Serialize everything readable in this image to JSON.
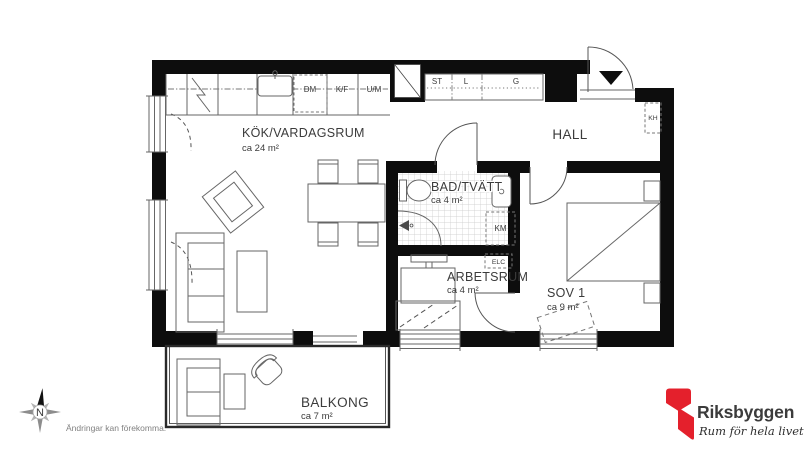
{
  "plan": {
    "rooms": {
      "kitchen_living": {
        "name": "KÖK/VARDAGSRUM",
        "area": "ca 24 m²"
      },
      "hall": {
        "name": "HALL"
      },
      "bath": {
        "name": "BAD/TVÄTT",
        "area": "ca 4 m²"
      },
      "office": {
        "name": "ARBETSRUM",
        "area": "ca 4 m²"
      },
      "bedroom": {
        "name": "SOV 1",
        "area": "ca 9 m²"
      },
      "balcony": {
        "name": "BALKONG",
        "area": "ca 7 m²"
      }
    },
    "fixtures": {
      "dishwasher": "DM",
      "fridge_freezer": "K/F",
      "oven_microwave": "U/M",
      "cleaning_closet": "ST",
      "linen_closet": "L",
      "wardrobe": "G",
      "coat_rack": "KH",
      "washing_machine": "KM",
      "electrical_cabinet": "ELC"
    }
  },
  "compass": {
    "north": "N"
  },
  "footer": {
    "disclaimer": "Ändringar kan förekomma."
  },
  "logo": {
    "brand": "Riksbyggen",
    "tagline": "Rum för hela livet"
  },
  "colors": {
    "wall": "#0d0d0d",
    "furniture_line": "#666666",
    "text": "#3b3b3b",
    "logo_red": "#E4202C",
    "logo_gray": "#8D9093"
  }
}
